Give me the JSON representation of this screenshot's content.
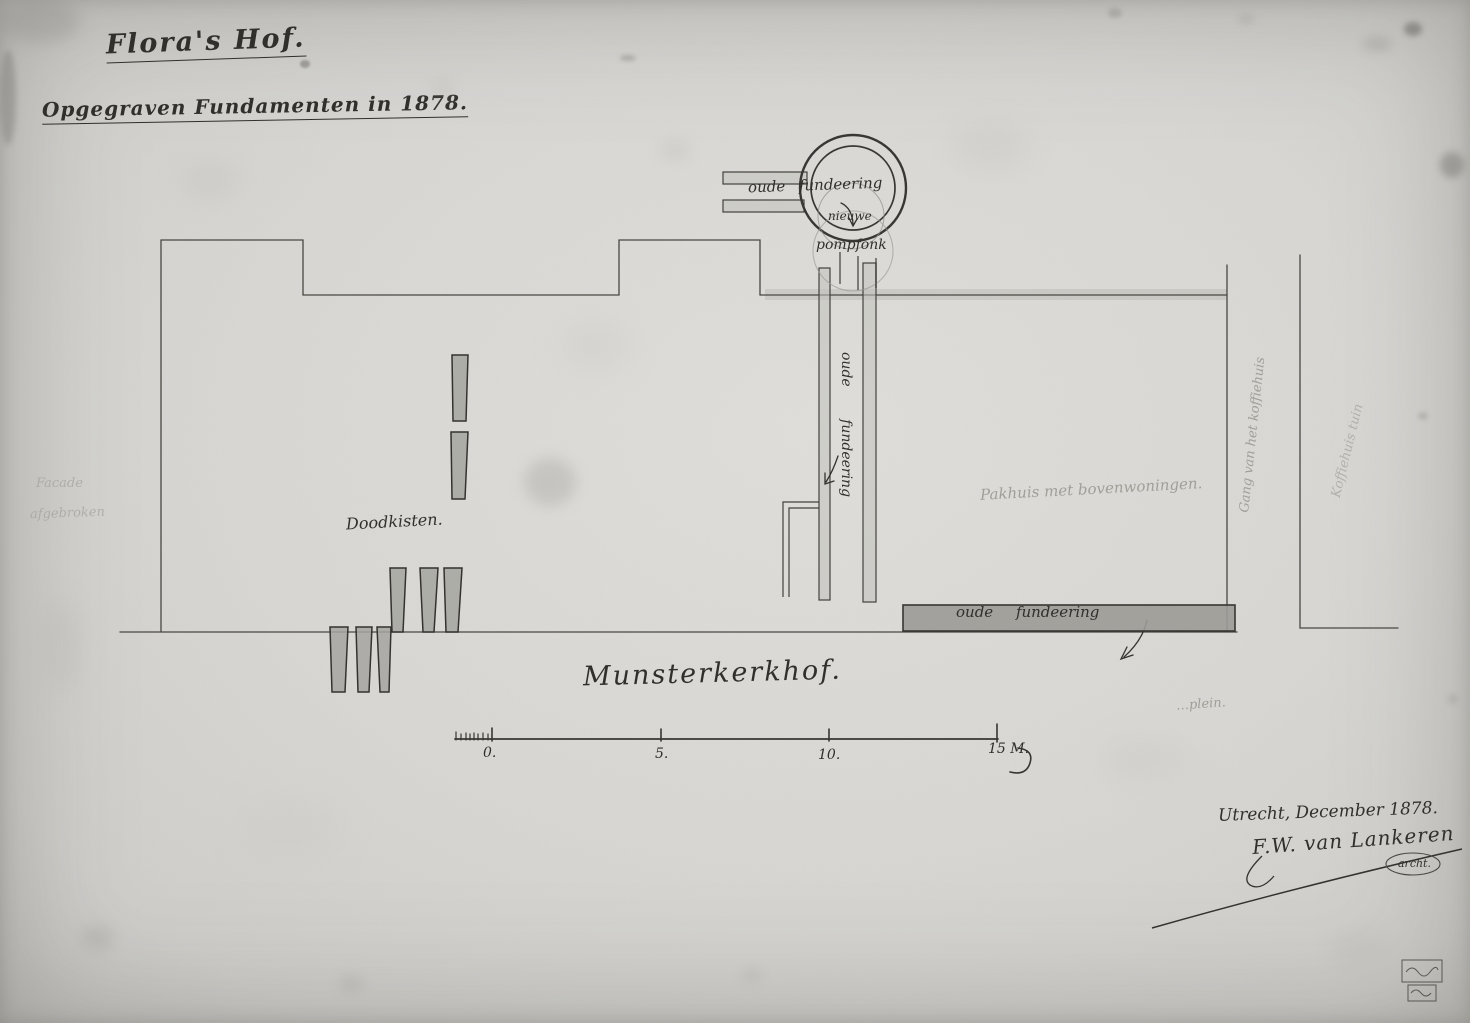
{
  "document": {
    "title": "Flora's Hof.",
    "subtitle": "Opgegraven Fundamenten in 1878.",
    "place_date": "Utrecht, December 1878.",
    "signature": "F.W. van Lankeren",
    "signature_title": "archt."
  },
  "plan_labels": {
    "old_foundation": "oude fundeering",
    "new": "nieuwe",
    "pump": "pompfonk",
    "coffins": "Doodkisten.",
    "warehouse": "Pakhuis met bovenwoningen.",
    "passage": "Gang van het koffiehuis",
    "coffeehouse_garden": "Koffiehuis tuin",
    "cemetery": "Munsterkerkhof.",
    "square": "…plein.",
    "facade_note_1": "Facade",
    "facade_note_2": "afgebroken"
  },
  "scale_bar": {
    "labels": [
      "0.",
      "5.",
      "10."
    ],
    "end_label": "15 M."
  },
  "colors": {
    "paper": "#d9d8d5",
    "ink": "#2c2a26",
    "pencil": "#97948c",
    "foundation_wash": "#9b9a96"
  }
}
